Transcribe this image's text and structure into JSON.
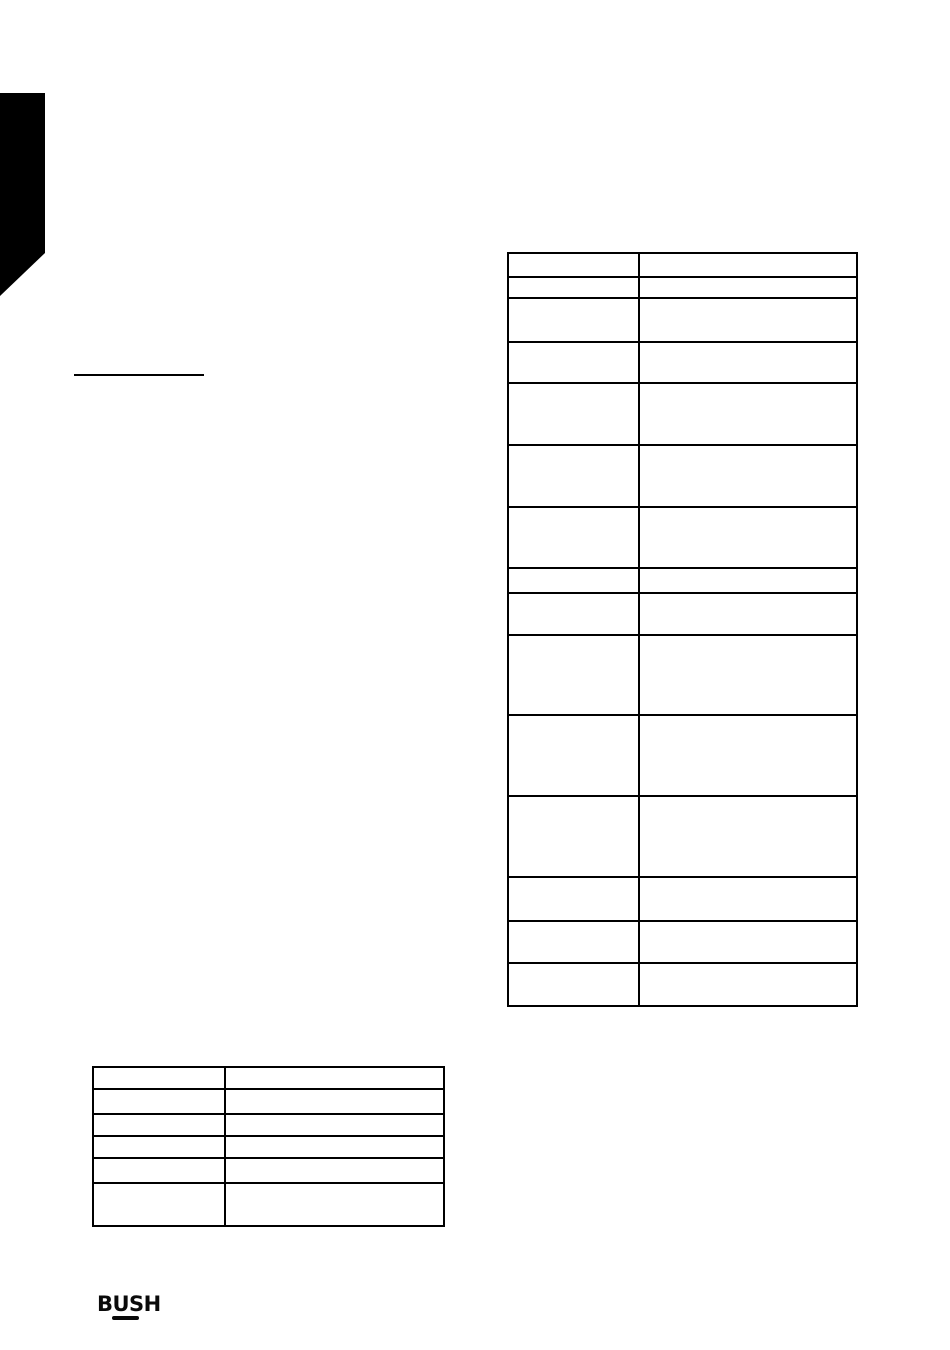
{
  "page": {
    "background": "#ffffff",
    "ink": "#000000"
  },
  "decorations": {
    "corner_tab": {
      "color": "#000000"
    },
    "heading_rule": {
      "color": "#000000"
    }
  },
  "logo": {
    "text": "BUSH",
    "underline_color": "#0a0a0a"
  },
  "tables": [
    {
      "id": "right-table",
      "col_widths": [
        131,
        218
      ],
      "rows": [
        {
          "height": 24,
          "cells": [
            "",
            ""
          ]
        },
        {
          "height": 21,
          "cells": [
            "",
            ""
          ]
        },
        {
          "height": 44,
          "cells": [
            "",
            ""
          ]
        },
        {
          "height": 41,
          "cells": [
            "",
            ""
          ]
        },
        {
          "height": 62,
          "cells": [
            "",
            ""
          ]
        },
        {
          "height": 62,
          "cells": [
            "",
            ""
          ]
        },
        {
          "height": 61,
          "cells": [
            "",
            ""
          ]
        },
        {
          "height": 25,
          "cells": [
            "",
            ""
          ]
        },
        {
          "height": 42,
          "cells": [
            "",
            ""
          ]
        },
        {
          "height": 80,
          "cells": [
            "",
            ""
          ]
        },
        {
          "height": 81,
          "cells": [
            "",
            ""
          ]
        },
        {
          "height": 81,
          "cells": [
            "",
            ""
          ]
        },
        {
          "height": 44,
          "cells": [
            "",
            ""
          ]
        },
        {
          "height": 42,
          "cells": [
            "",
            ""
          ]
        },
        {
          "height": 43,
          "cells": [
            "",
            ""
          ]
        }
      ]
    },
    {
      "id": "bottom-left-table",
      "col_widths": [
        132,
        219
      ],
      "rows": [
        {
          "height": 22,
          "cells": [
            "",
            ""
          ]
        },
        {
          "height": 25,
          "cells": [
            "",
            ""
          ]
        },
        {
          "height": 22,
          "cells": [
            "",
            ""
          ]
        },
        {
          "height": 22,
          "cells": [
            "",
            ""
          ]
        },
        {
          "height": 25,
          "cells": [
            "",
            ""
          ]
        },
        {
          "height": 43,
          "cells": [
            "",
            ""
          ]
        }
      ]
    }
  ]
}
